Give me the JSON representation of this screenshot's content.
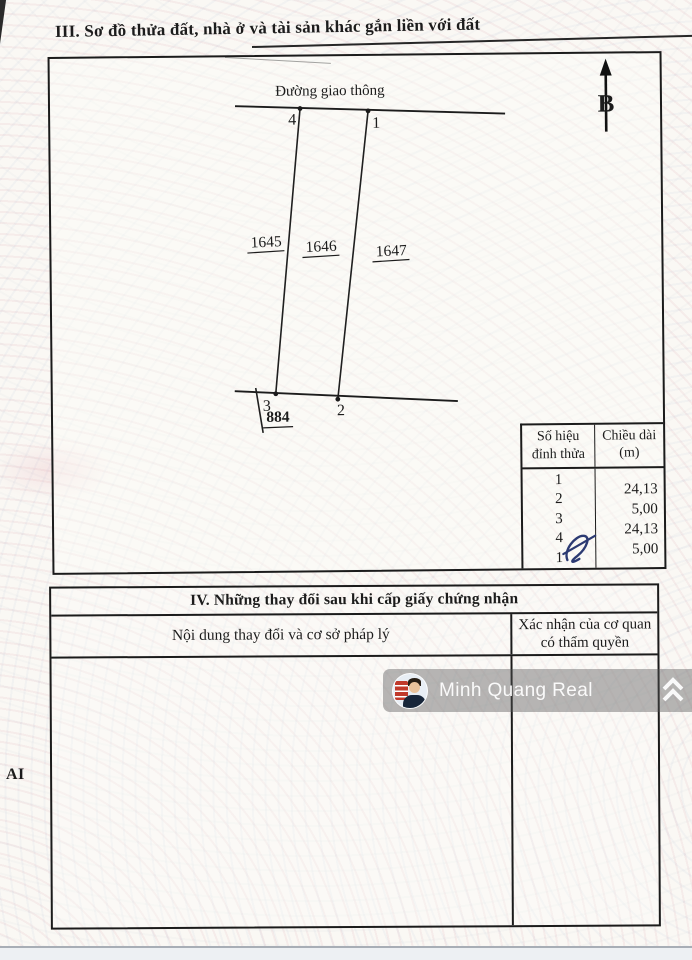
{
  "colors": {
    "paper": "#faf8f4",
    "ink": "#1c1c1c",
    "pen_ink": "#2c3a72",
    "watermark_band": "#8c8c8c",
    "watermark_text": "#ffffff"
  },
  "page": {
    "section3_title": "III. Sơ đồ thửa đất, nhà ở và tài sản khác gắn liền với đất",
    "margin_label": "AI"
  },
  "diagram": {
    "road_label": "Đường giao thông",
    "north_label": "B",
    "vertex_labels": {
      "top_left": "4",
      "top_right": "1",
      "bottom_left": "3",
      "bottom_right": "2"
    },
    "parcel_ids": [
      "1645",
      "1646",
      "1647"
    ],
    "adjacent_parcel_id": "884"
  },
  "dimension_table": {
    "col1_header": "Số hiệu đỉnh thửa",
    "col2_header_line1": "Chiều dài",
    "col2_header_line2": "(m)",
    "vertex_ids": [
      "1",
      "2",
      "3",
      "4",
      "1"
    ],
    "lengths": [
      "24,13",
      "5,00",
      "24,13",
      "5,00"
    ]
  },
  "section4": {
    "title": "IV. Những thay đổi sau khi cấp giấy chứng nhận",
    "col1_header": "Nội dung thay đổi và cơ sở pháp lý",
    "col2_header": "Xác nhận của cơ quan có thẩm quyền"
  },
  "watermark": {
    "name": "Minh Quang Real",
    "logo_icon": "double-chevron-up"
  }
}
